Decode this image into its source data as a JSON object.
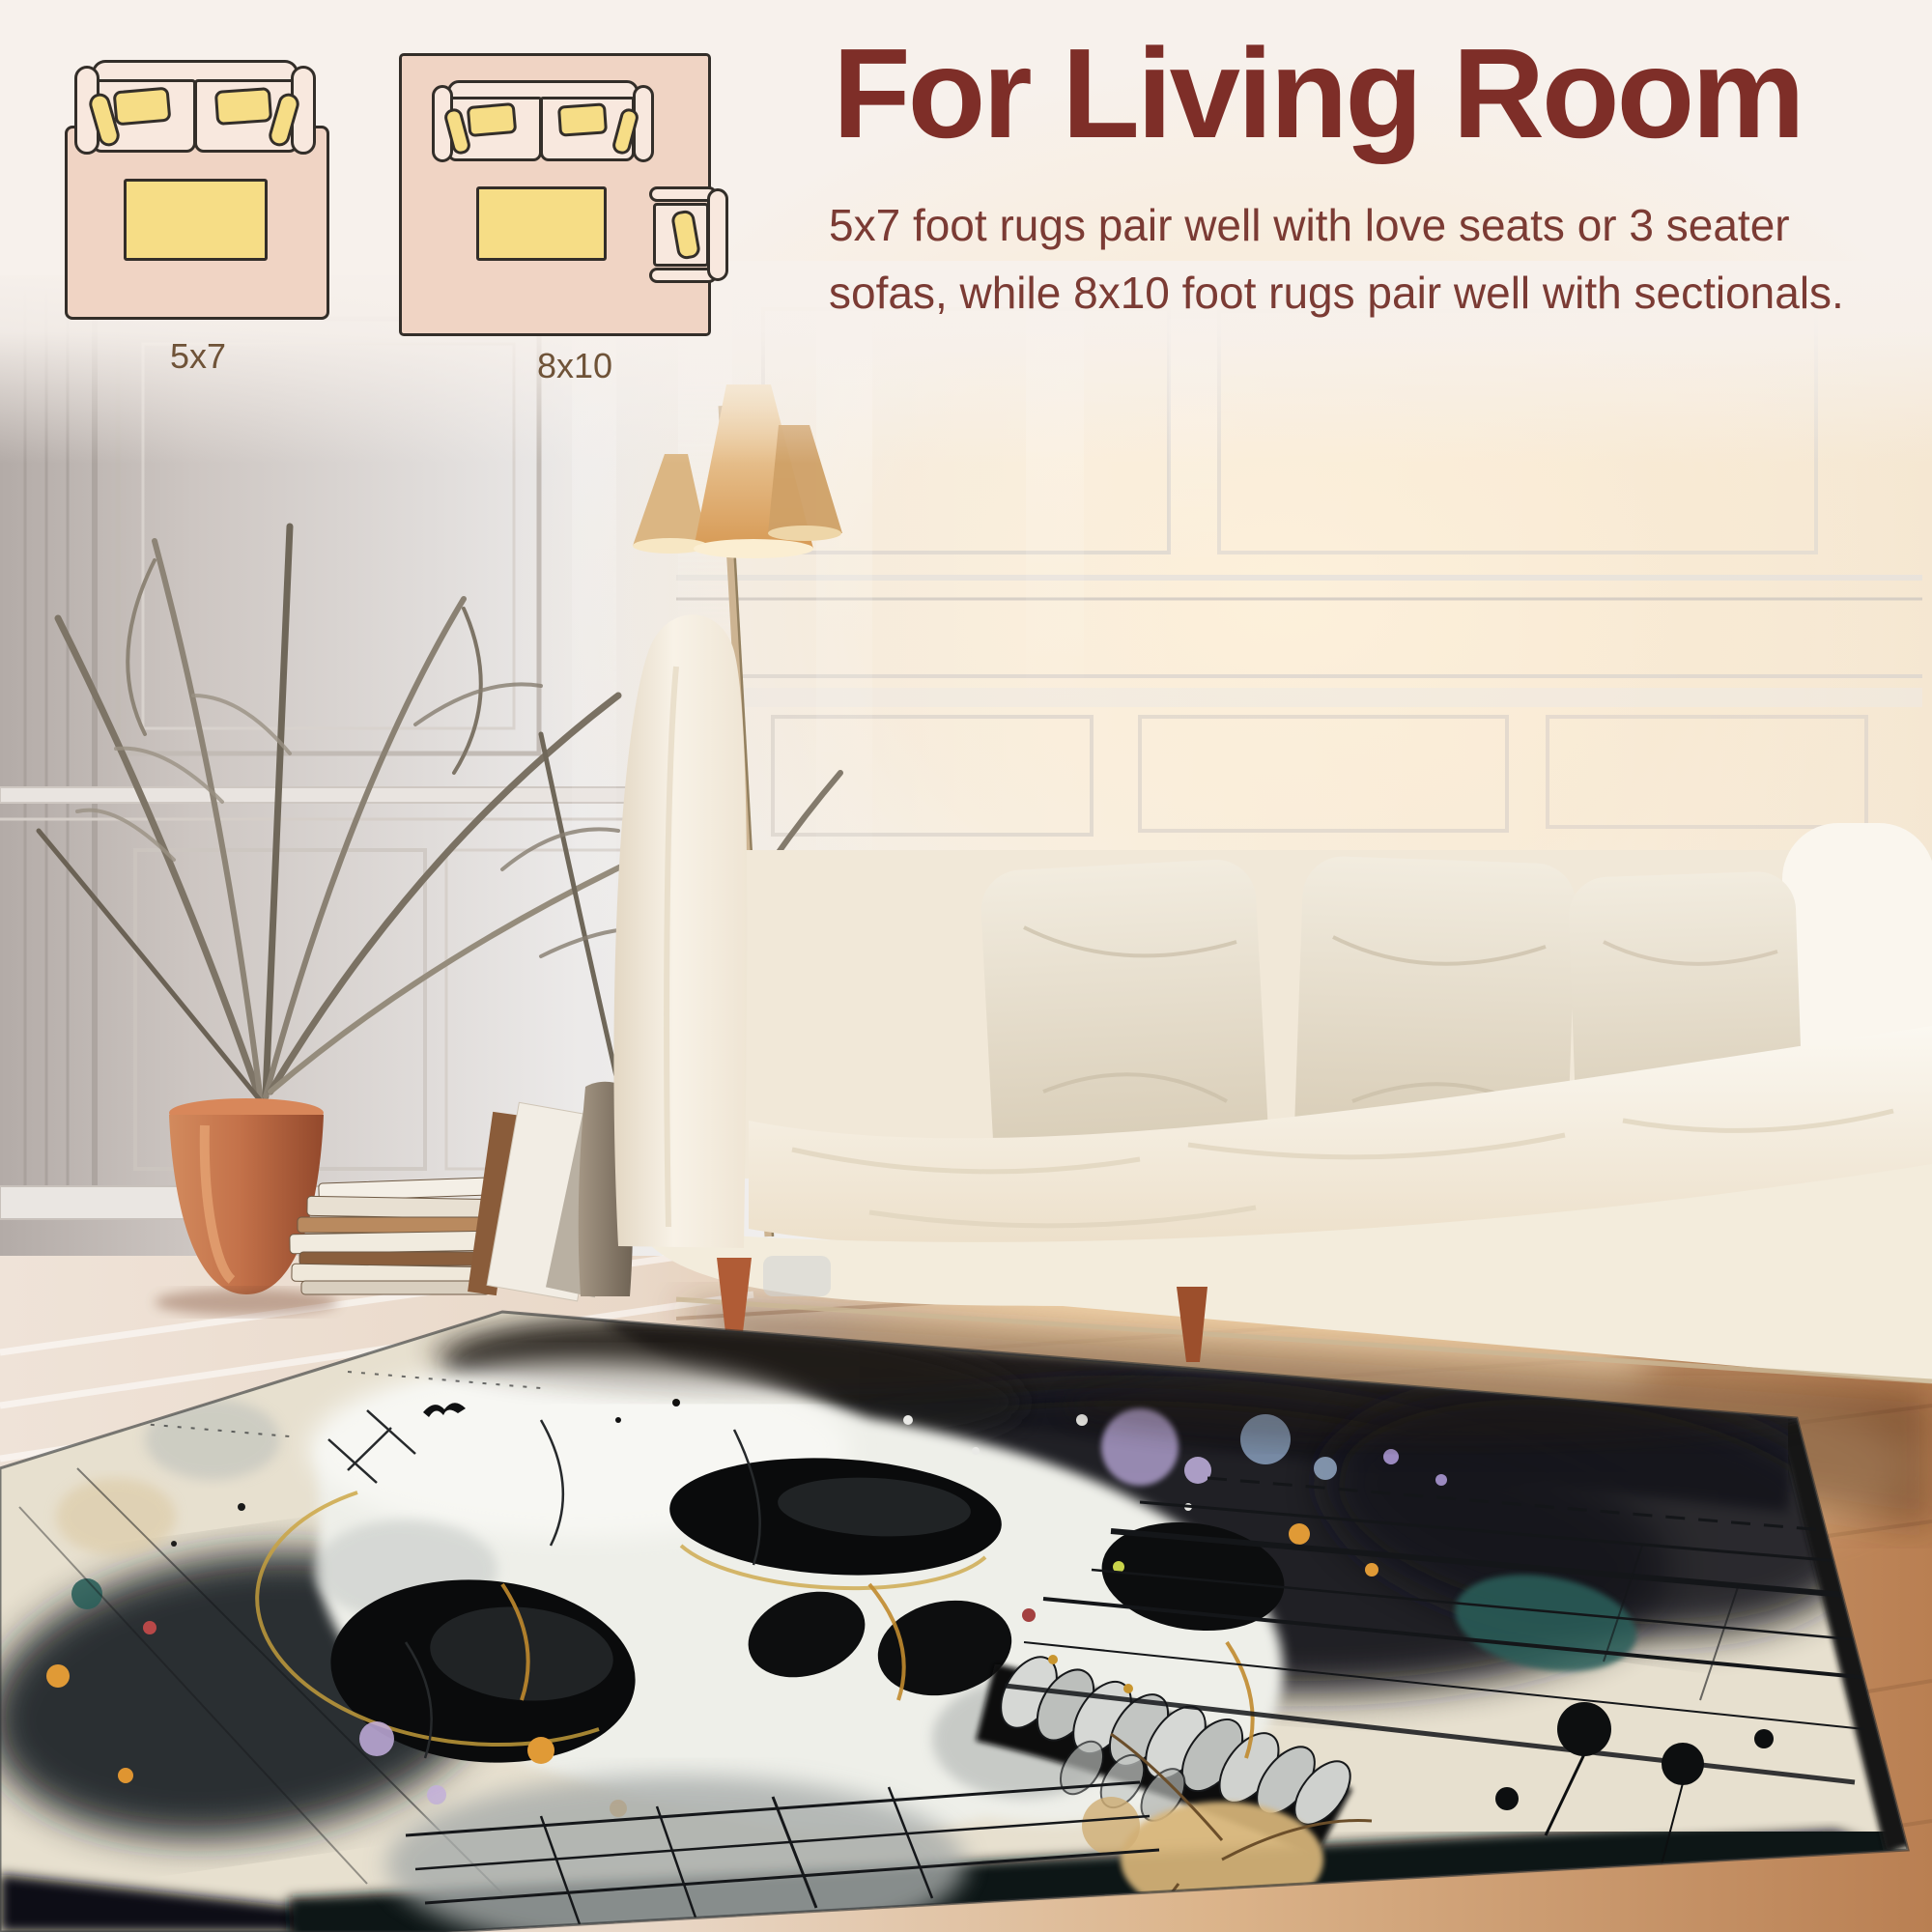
{
  "header": {
    "title": "For Living Room",
    "description_lines": [
      "5x7 foot rugs pair well with love seats or 3 seater",
      "sofas, while 8x10 foot rugs pair well with sectionals."
    ],
    "title_color": "#7e2e28",
    "body_color": "#7b3b34"
  },
  "diagrams": [
    {
      "label": "5x7",
      "furniture": "loveseat with coffee table on rug"
    },
    {
      "label": "8x10",
      "furniture": "3 seater sofa, coffee table and armchair on rug"
    }
  ],
  "diagram_colors": {
    "rug_pink": "#f0d4c4",
    "sofa_body": "#f8e8de",
    "pillow_yellow": "#f6dd86",
    "outline": "#332e29",
    "label_brown": "#6f5338",
    "background_cream": "#f7f1ec"
  },
  "scene": {
    "description": "sunlit living room with white paneled wall, cream sofa, dried palm plant, floor lamp, stacked books and an abstract skull art rug on a wood floor",
    "palette": {
      "wall_white": "#f3f1f0",
      "wall_shadow": "#b9b1ad",
      "sofa_cream": "#f8f2e7",
      "pillow_beige": "#e9e1d1",
      "pot_terracotta": "#bf6f48",
      "lamp_shade": "#e3bc88",
      "floor_whitewash": "#ecdfd3",
      "floor_warm": "#cf9a6c",
      "sun_glow": "#f9e3c2"
    },
    "rug_art": {
      "style": "abstract watercolor skull with paint splatter and grid lines",
      "base_cream": "#e7e0cf",
      "ink_black": "#16191c",
      "skull_white": "#eeefe9",
      "gold": "#c08a2e",
      "teal": "#2b5f5a",
      "lavender": "#b5a4d4",
      "orange": "#e09a36",
      "tan": "#d8b67a",
      "gray": "#a7acaa"
    }
  }
}
